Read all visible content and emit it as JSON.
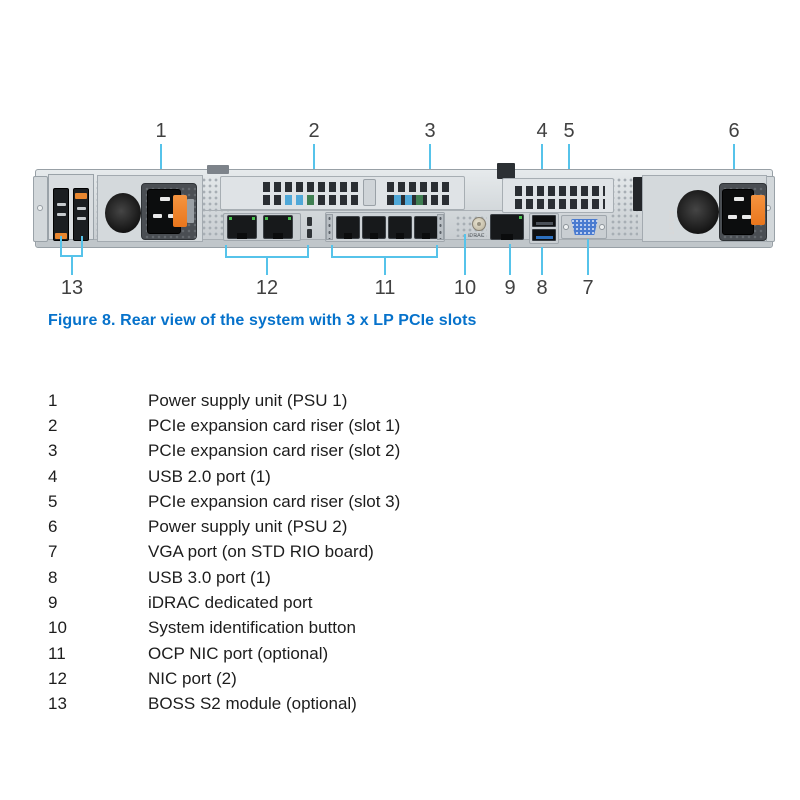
{
  "figure": {
    "caption": "Figure 8. Rear view of the system with 3 x LP PCIe slots",
    "callout_color": "#56C3EA",
    "caption_color": "#0672CB",
    "psu2_wattage_label": "1400W",
    "idrac_port_label": "iDRAC",
    "callouts_top": [
      {
        "n": "1"
      },
      {
        "n": "2"
      },
      {
        "n": "3"
      },
      {
        "n": "4"
      },
      {
        "n": "5"
      },
      {
        "n": "6"
      }
    ],
    "callouts_bottom": [
      {
        "n": "13"
      },
      {
        "n": "12"
      },
      {
        "n": "11"
      },
      {
        "n": "10"
      },
      {
        "n": "9"
      },
      {
        "n": "8"
      },
      {
        "n": "7"
      }
    ]
  },
  "legend": {
    "items": [
      {
        "num": "1",
        "desc": "Power supply unit (PSU 1)"
      },
      {
        "num": "2",
        "desc": "PCIe expansion card riser (slot 1)"
      },
      {
        "num": "3",
        "desc": "PCIe expansion card riser (slot 2)"
      },
      {
        "num": "4",
        "desc": "USB 2.0 port (1)"
      },
      {
        "num": "5",
        "desc": "PCIe expansion card riser (slot 3)"
      },
      {
        "num": "6",
        "desc": "Power supply unit (PSU 2)"
      },
      {
        "num": "7",
        "desc": "VGA port (on STD RIO board)"
      },
      {
        "num": "8",
        "desc": "USB 3.0 port (1)"
      },
      {
        "num": "9",
        "desc": "iDRAC dedicated port"
      },
      {
        "num": "10",
        "desc": "System identification button"
      },
      {
        "num": "11",
        "desc": "OCP NIC port (optional)"
      },
      {
        "num": "12",
        "desc": "NIC port (2)"
      },
      {
        "num": "13",
        "desc": "BOSS S2 module (optional)"
      }
    ]
  }
}
